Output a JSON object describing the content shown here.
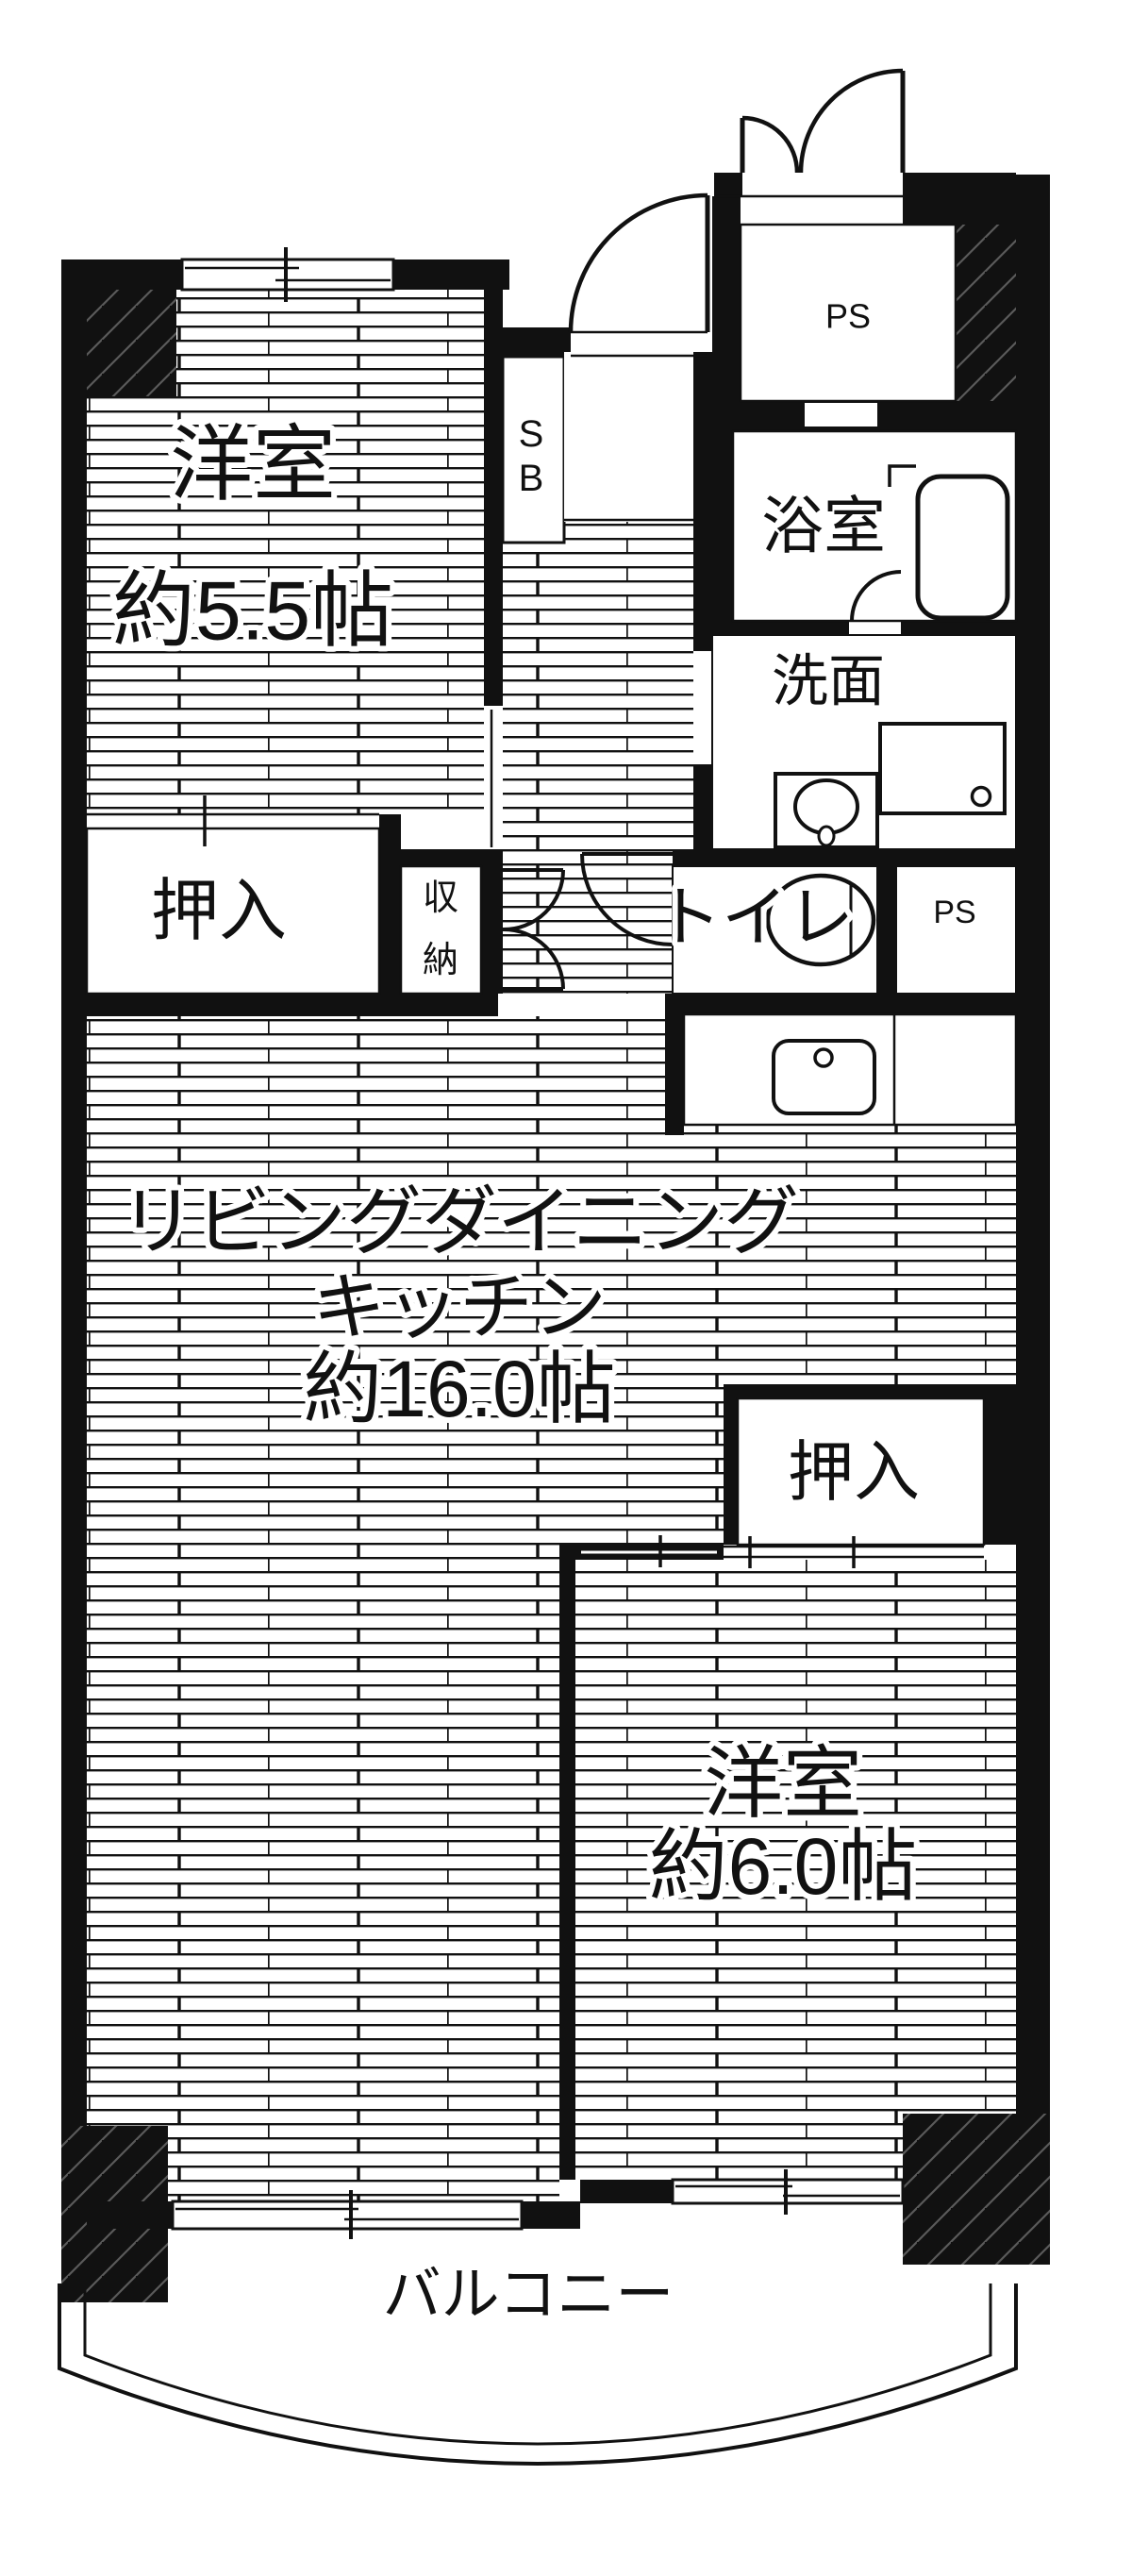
{
  "plan": {
    "title": "apartment-floor-plan",
    "colors": {
      "wall": "#111111",
      "background": "#ffffff",
      "hatch_line": "#5a5a5a"
    },
    "rooms": {
      "bedroom55": {
        "name": "洋室",
        "size": "約5.5帖"
      },
      "bedroom60": {
        "name": "洋室",
        "size": "約6.0帖"
      },
      "ldk": {
        "line1": "リビングダイニング",
        "line2": "キッチン",
        "line3": "約16.0帖"
      },
      "bathroom": {
        "label": "浴室"
      },
      "washroom": {
        "label": "洗面"
      },
      "toilet": {
        "label": "トイレ"
      },
      "closet1": {
        "label": "押入"
      },
      "closet2": {
        "label": "押入"
      },
      "storage": {
        "char1": "収",
        "char2": "納"
      },
      "shoebox": {
        "char1": "S",
        "char2": "B"
      },
      "ps_top": {
        "label": "PS"
      },
      "ps_middle": {
        "label": "PS"
      },
      "balcony": {
        "label": "バルコニー"
      }
    }
  }
}
